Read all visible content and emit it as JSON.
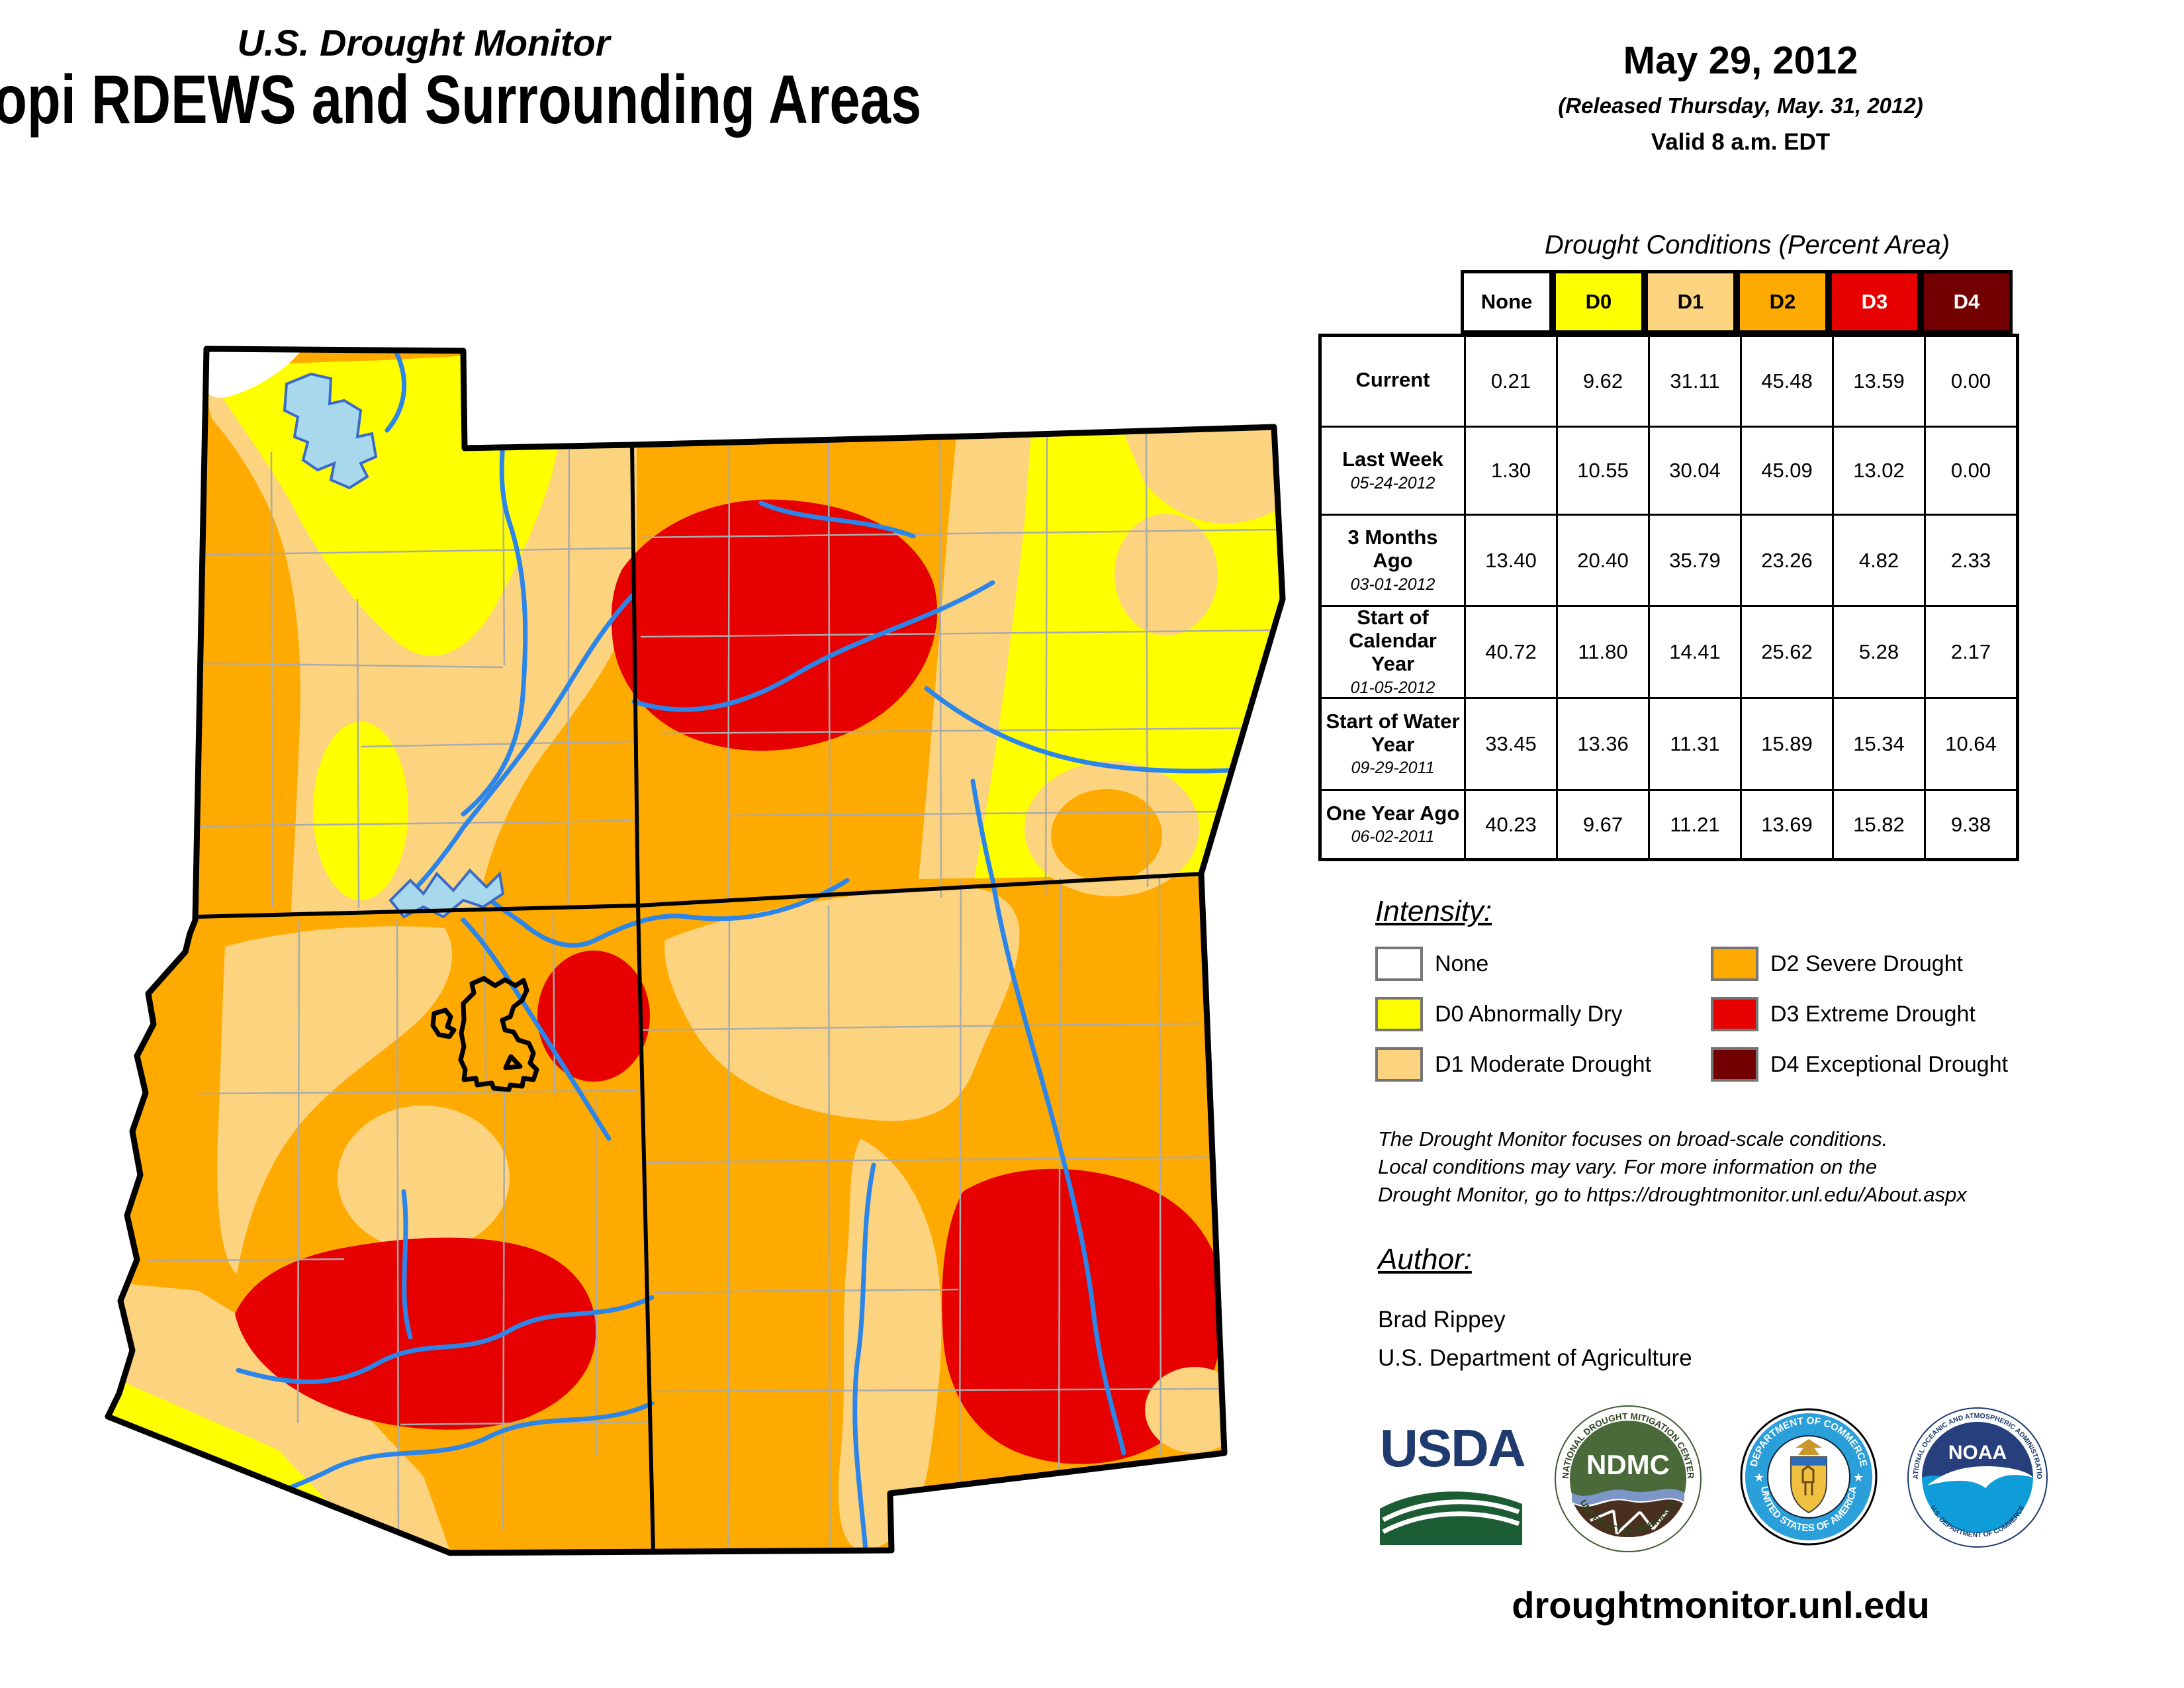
{
  "header": {
    "monitor_title": "U.S. Drought Monitor",
    "region_title": "Hopi RDEWS and Surrounding Areas",
    "date": "May 29, 2012",
    "released": "(Released Thursday, May. 31, 2012)",
    "valid": "Valid 8 a.m. EDT"
  },
  "table": {
    "title": "Drought Conditions (Percent Area)",
    "columns": [
      "None",
      "D0",
      "D1",
      "D2",
      "D3",
      "D4"
    ],
    "rows": [
      {
        "label": "Current",
        "date": "",
        "values": [
          "0.21",
          "9.62",
          "31.11",
          "45.48",
          "13.59",
          "0.00"
        ]
      },
      {
        "label": "Last Week",
        "date": "05-24-2012",
        "values": [
          "1.30",
          "10.55",
          "30.04",
          "45.09",
          "13.02",
          "0.00"
        ]
      },
      {
        "label": "3 Months Ago",
        "date": "03-01-2012",
        "values": [
          "13.40",
          "20.40",
          "35.79",
          "23.26",
          "4.82",
          "2.33"
        ]
      },
      {
        "label": "Start of Calendar Year",
        "date": "01-05-2012",
        "values": [
          "40.72",
          "11.80",
          "14.41",
          "25.62",
          "5.28",
          "2.17"
        ]
      },
      {
        "label": "Start of Water Year",
        "date": "09-29-2011",
        "values": [
          "33.45",
          "13.36",
          "11.31",
          "15.89",
          "15.34",
          "10.64"
        ]
      },
      {
        "label": "One Year Ago",
        "date": "06-02-2011",
        "values": [
          "40.23",
          "9.67",
          "11.21",
          "13.69",
          "15.82",
          "9.38"
        ]
      }
    ]
  },
  "legend": {
    "heading": "Intensity:",
    "items": [
      {
        "label": "None",
        "color": "#FFFFFF"
      },
      {
        "label": "D0 Abnormally Dry",
        "color": "#FFFF00"
      },
      {
        "label": "D1 Moderate Drought",
        "color": "#FCD37F"
      },
      {
        "label": "D2 Severe Drought",
        "color": "#FFAA00"
      },
      {
        "label": "D3 Extreme Drought",
        "color": "#E60000"
      },
      {
        "label": "D4 Exceptional Drought",
        "color": "#730000"
      }
    ]
  },
  "notes": {
    "line1": "The Drought Monitor focuses on broad-scale conditions.",
    "line2": "Local conditions may vary. For more information on the",
    "line3": "Drought Monitor, go to https://droughtmonitor.unl.edu/About.aspx"
  },
  "author": {
    "heading": "Author:",
    "name": "Brad Rippey",
    "org": "U.S. Department of Agriculture"
  },
  "logos": {
    "usda": "USDA",
    "ndmc_center": "NDMC",
    "ndmc_top": "NATIONAL DROUGHT MITIGATION CENTER",
    "ndmc_bottom": "UNIVERSITY OF NEBRASKA",
    "doc_top": "DEPARTMENT OF COMMERCE",
    "doc_bottom": "UNITED STATES OF AMERICA",
    "noaa_center": "NOAA",
    "noaa_top": "NATIONAL OCEANIC AND ATMOSPHERIC ADMINISTRATION",
    "noaa_bottom": "U.S. DEPARTMENT OF COMMERCE"
  },
  "footer": {
    "url": "droughtmonitor.unl.edu"
  },
  "colors": {
    "none": "#FFFFFF",
    "d0": "#FFFF00",
    "d1": "#FCD37F",
    "d2": "#FFAA00",
    "d3": "#E60000",
    "d4": "#730000",
    "lake": "#A8D8EC",
    "river": "#2C85E8",
    "county_line": "#ABABAB",
    "state_border": "#000000"
  }
}
